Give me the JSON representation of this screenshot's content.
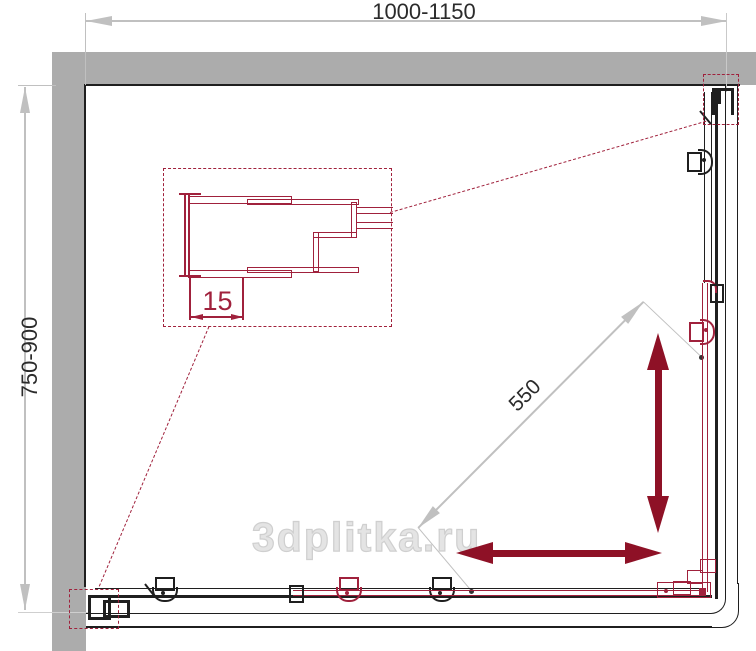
{
  "drawing": {
    "type": "corner-shower-enclosure-plan",
    "labels": {
      "width_range": "1000-1150",
      "depth_range": "750-900",
      "diagonal_entry_width": "550",
      "profile_adjustment": "15"
    },
    "watermark": "3dplitka.ru"
  },
  "colors": {
    "wall_gray": "#acacac",
    "line_black": "#1f1f1f",
    "line_red": "#a0213c",
    "arrow_dark_red": "#8e1126",
    "dimension_gray": "#c0c0c0",
    "text_dark": "#2b2b2b",
    "watermark_gray": "#e4e4e4"
  }
}
